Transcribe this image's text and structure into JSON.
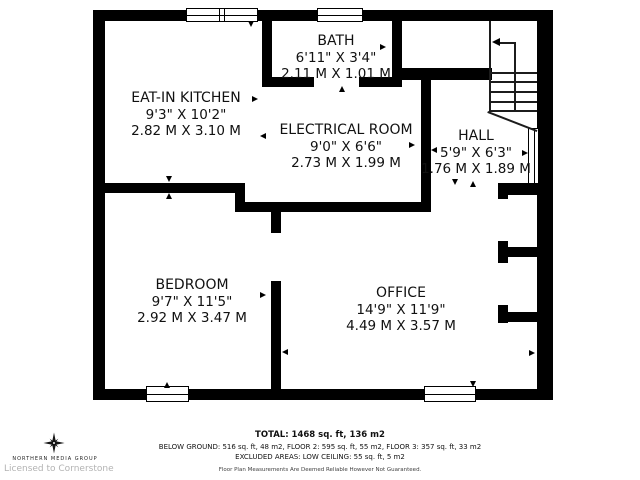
{
  "rooms": [
    {
      "name": "EAT-IN KITCHEN",
      "imperial": "9'3\" X 10'2\"",
      "metric": "2.82 M X 3.10 M"
    },
    {
      "name": "BATH",
      "imperial": "6'11\" X 3'4\"",
      "metric": "2.11 M X 1.01 M"
    },
    {
      "name": "ELECTRICAL ROOM",
      "imperial": "9'0\" X 6'6\"",
      "metric": "2.73 M X 1.99 M"
    },
    {
      "name": "HALL",
      "imperial": "5'9\" X 6'3\"",
      "metric": "1.76 M X 1.89 M"
    },
    {
      "name": "BEDROOM",
      "imperial": "9'7\" X 11'5\"",
      "metric": "2.92 M X 3.47 M"
    },
    {
      "name": "OFFICE",
      "imperial": "14'9\" X 11'9\"",
      "metric": "4.49 M X 3.57 M"
    }
  ],
  "summary": {
    "total": "TOTAL: 1468 sq. ft, 136 m2",
    "floors": "BELOW GROUND: 516 sq. ft, 48 m2, FLOOR 2: 595 sq. ft, 55 m2, FLOOR 3: 357 sq. ft, 33 m2",
    "excluded": "EXCLUDED AREAS: LOW CEILING: 55 sq. ft, 5 m2",
    "disclaimer": "Floor Plan Measurements Are Deemed Reliable However Not Guaranteed."
  },
  "branding": {
    "company": "NORTHERN MEDIA GROUP",
    "license": "Licensed to Cornerstone",
    "logo_icon": "compass-star-icon"
  },
  "colors": {
    "wall": "#000000",
    "background": "#ffffff",
    "license_text": "#b3b3b3"
  }
}
